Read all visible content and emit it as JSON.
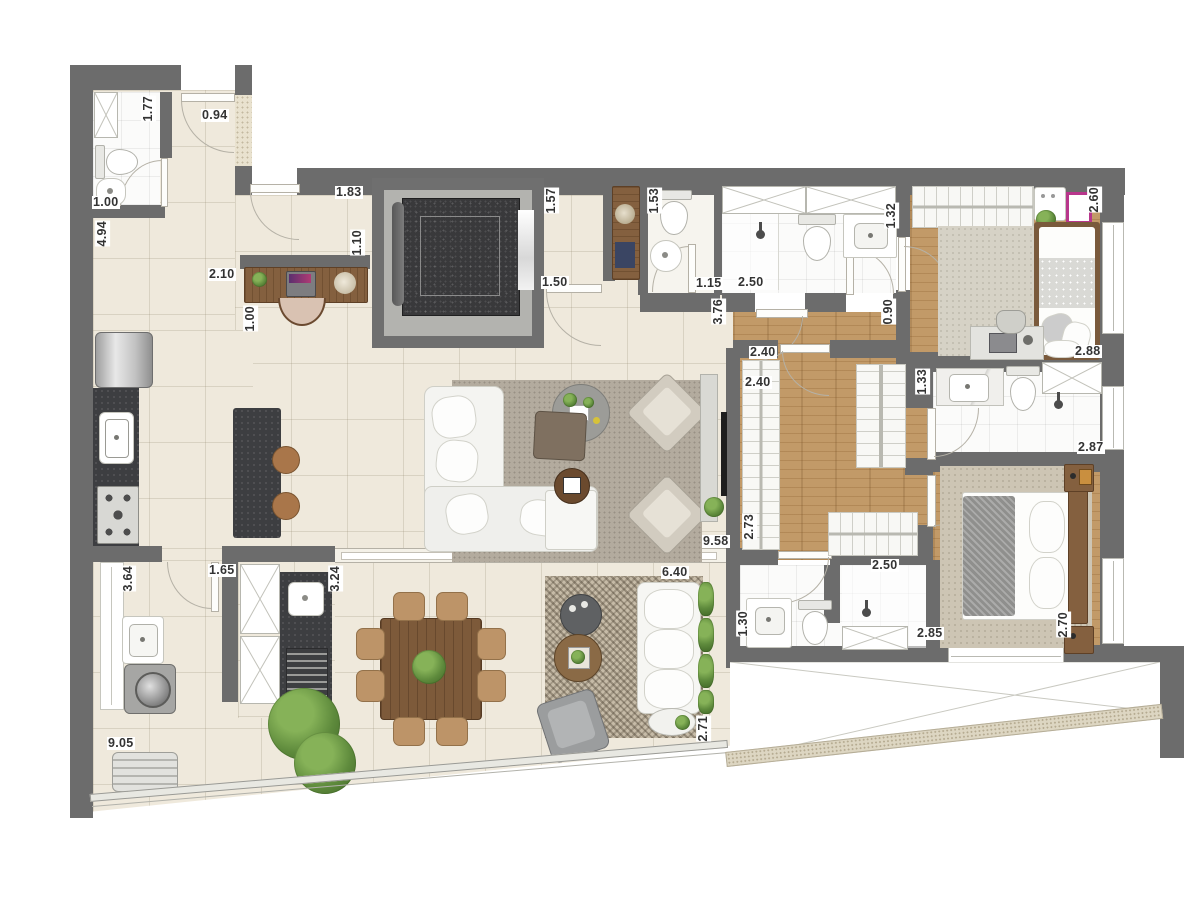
{
  "plan": {
    "type": "apartment-floor-plan",
    "width_px": 1200,
    "height_px": 906
  },
  "colors": {
    "wall": "#6C6C6C",
    "floor_tile": "#EFE9DC",
    "floor_wood": "#C29A68",
    "floor_bath": "#FBFBFA",
    "counter_dark": "#3D3E41",
    "furniture_wood": "#84603F",
    "elevator_core": "#39393B",
    "rug_living": "#B3AB9E",
    "rug_checker": "#C6BBA7",
    "chair_tan": "#BD9468",
    "plant_green": "#5E8A3C",
    "runner_navy": "#3A4563",
    "frame_pink": "#B8368C",
    "label_text": "#333333",
    "label_bg": "#FFFFFF"
  },
  "furniture_icons": [
    "toilet-icon",
    "sink-icon",
    "shower-head-icon",
    "bathtub-shower-box-icon",
    "wardrobe-hanger-icon",
    "elevator-icon",
    "desk-icon",
    "laptop-icon",
    "office-chair-icon",
    "console-table-icon",
    "lamp-icon",
    "fridge-icon",
    "kitchen-sink-icon",
    "cooktop-icon",
    "island-counter-icon",
    "stool-icon",
    "sectional-sofa-icon",
    "coffee-table-icon",
    "ottoman-icon",
    "armchair-icon",
    "tv-panel-icon",
    "dining-table-icon",
    "dining-chair-icon",
    "outdoor-sofa-icon",
    "grill-icon",
    "washer-icon",
    "laundry-sink-icon",
    "double-bed-icon",
    "single-bed-icon",
    "nightstand-icon",
    "bench-icon",
    "plant-icon",
    "rug-icon",
    "picture-frame-icon"
  ],
  "dimension_labels": [
    {
      "text": "1.77",
      "x": 141,
      "y": 96,
      "vertical": true
    },
    {
      "text": "0.94",
      "x": 201,
      "y": 109,
      "vertical": false
    },
    {
      "text": "1.00",
      "x": 92,
      "y": 196,
      "vertical": false
    },
    {
      "text": "4.94",
      "x": 95,
      "y": 221,
      "vertical": true
    },
    {
      "text": "1.83",
      "x": 335,
      "y": 186,
      "vertical": false
    },
    {
      "text": "1.10",
      "x": 350,
      "y": 230,
      "vertical": true
    },
    {
      "text": "2.10",
      "x": 208,
      "y": 268,
      "vertical": false
    },
    {
      "text": "1.00",
      "x": 243,
      "y": 306,
      "vertical": true
    },
    {
      "text": "1.57",
      "x": 544,
      "y": 188,
      "vertical": true
    },
    {
      "text": "1.50",
      "x": 541,
      "y": 276,
      "vertical": false
    },
    {
      "text": "1.53",
      "x": 647,
      "y": 188,
      "vertical": true
    },
    {
      "text": "1.15",
      "x": 695,
      "y": 277,
      "vertical": false
    },
    {
      "text": "2.50",
      "x": 737,
      "y": 276,
      "vertical": false
    },
    {
      "text": "1.32",
      "x": 884,
      "y": 203,
      "vertical": true
    },
    {
      "text": "2.60",
      "x": 1087,
      "y": 187,
      "vertical": true
    },
    {
      "text": "2.88",
      "x": 1074,
      "y": 345,
      "vertical": false
    },
    {
      "text": "3.76",
      "x": 711,
      "y": 299,
      "vertical": true
    },
    {
      "text": "0.90",
      "x": 881,
      "y": 299,
      "vertical": true
    },
    {
      "text": "2.40",
      "x": 749,
      "y": 346,
      "vertical": false
    },
    {
      "text": "2.40",
      "x": 744,
      "y": 376,
      "vertical": false
    },
    {
      "text": "1.33",
      "x": 915,
      "y": 369,
      "vertical": true
    },
    {
      "text": "2.87",
      "x": 1077,
      "y": 441,
      "vertical": false
    },
    {
      "text": "2.73",
      "x": 742,
      "y": 514,
      "vertical": true
    },
    {
      "text": "9.58",
      "x": 702,
      "y": 535,
      "vertical": false
    },
    {
      "text": "2.50",
      "x": 871,
      "y": 559,
      "vertical": false
    },
    {
      "text": "2.85",
      "x": 916,
      "y": 627,
      "vertical": false
    },
    {
      "text": "2.70",
      "x": 1056,
      "y": 612,
      "vertical": true
    },
    {
      "text": "1.30",
      "x": 736,
      "y": 611,
      "vertical": true
    },
    {
      "text": "3.64",
      "x": 121,
      "y": 566,
      "vertical": true
    },
    {
      "text": "1.65",
      "x": 208,
      "y": 564,
      "vertical": false
    },
    {
      "text": "3.24",
      "x": 328,
      "y": 566,
      "vertical": true
    },
    {
      "text": "6.40",
      "x": 661,
      "y": 566,
      "vertical": false
    },
    {
      "text": "2.71",
      "x": 696,
      "y": 716,
      "vertical": true
    },
    {
      "text": "9.05",
      "x": 107,
      "y": 737,
      "vertical": false
    }
  ]
}
